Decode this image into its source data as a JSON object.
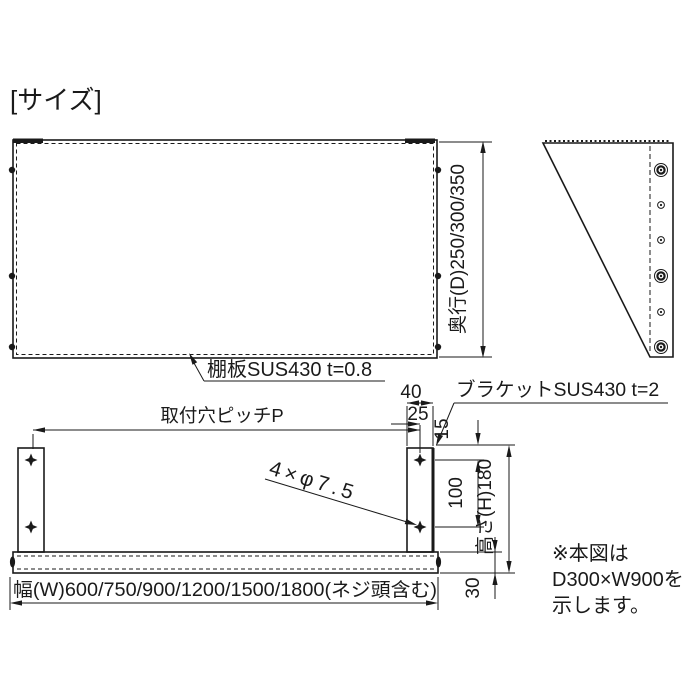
{
  "page": {
    "title": "[サイズ]",
    "ink_color": "#1a1a1a",
    "background_color": "#ffffff"
  },
  "top_view": {
    "depth_dimension": "奥行(D)250/300/350",
    "shelf_material_label": "棚板SUS430 t=0.8"
  },
  "front_view": {
    "pitch_dimension": "取付穴ピッチP",
    "dim_40": "40",
    "dim_25": "25",
    "bracket_material_label": "ブラケットSUS430 t=2",
    "dim_15": "15",
    "dim_100": "100",
    "height_dimension": "高さ(H)180",
    "dim_30": "30",
    "holes_spec": "4×φ7.5",
    "width_dimension": "幅(W)600/750/900/1200/1500/1800(ネジ頭含む)"
  },
  "note": {
    "line1": "※本図は",
    "line2": "D300×W900を",
    "line3": "示します。"
  }
}
